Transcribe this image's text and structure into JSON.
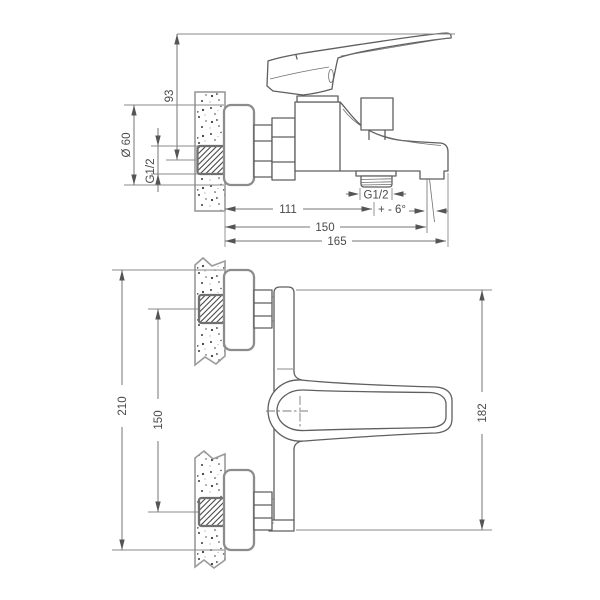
{
  "page": {
    "background": "#ffffff"
  },
  "drawing": {
    "type": "technical-diagram",
    "subject": "wall-mounted bath mixer tap shown in side elevation and plan projection with installation dimensions (mm)",
    "colors": {
      "outline": "#5f5f5f",
      "light_outline": "#8c8c8c",
      "dimension_line": "#757575",
      "label_text": "#4a4a4a",
      "hatch": "#4a4a4a",
      "background": "#ffffff"
    },
    "side_view": {
      "labels": {
        "height_to_handle_tip": "93",
        "flange_diameter": "Ø 60",
        "wall_connection_thread": "G1/2",
        "shower_outlet_thread": "G1/2",
        "wall_to_shower_outlet": "111",
        "spout_angle_tolerance": "+ - 6°",
        "wall_to_spout_outlet": "150",
        "total_projection": "165"
      }
    },
    "plan_view": {
      "labels": {
        "overall_flange_span": "210",
        "connection_centres": "150",
        "body_and_handle_span": "182"
      }
    }
  }
}
